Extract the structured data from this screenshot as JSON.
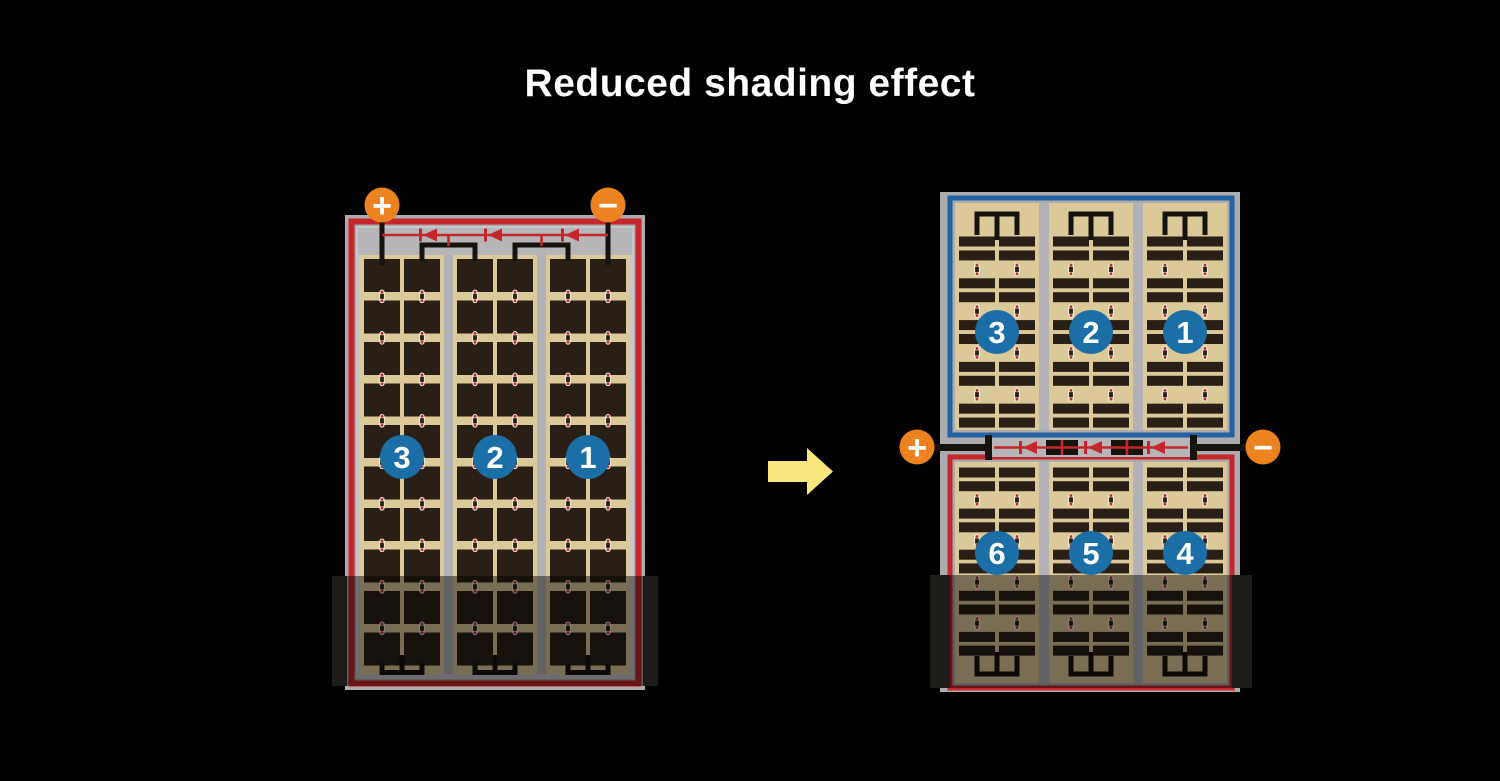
{
  "title": "Reduced shading effect",
  "left_panel": {
    "terminal_positive": "+",
    "terminal_negative": "−",
    "string_labels": [
      "3",
      "2",
      "1"
    ],
    "bypass_diode_count": 3
  },
  "right_panel": {
    "terminal_positive": "+",
    "terminal_negative": "−",
    "top_half_string_labels": [
      "3",
      "2",
      "1"
    ],
    "bottom_half_string_labels": [
      "6",
      "5",
      "4"
    ],
    "bypass_diode_count": 3
  },
  "colors": {
    "background": "#000000",
    "title_text": "#FFFFFF",
    "frame_gray": "#ACABAD",
    "wire_margin_gray": "#B6B5B7",
    "inner_margin_gray": "#C7C6C8",
    "separator_gray": "#B2B3B7",
    "cell_field_tan": "#DCC999",
    "cell_dark": "#2A1F16",
    "wire_black": "#16120E",
    "border_red": "#C4262B",
    "border_blue": "#2463A3",
    "diode_red": "#C4262B",
    "terminal_orange": "#EC8320",
    "terminal_glyph": "#FFFFFF",
    "badge_blue": "#1C6FA6",
    "badge_text": "#FFFFFF",
    "interconnect_white": "#F8F4EC",
    "interconnect_dot_red": "#C03028",
    "shade_bar": "#37342F",
    "shade_overlay": "rgba(0,0,0,0.45)",
    "arrow_yellow": "#F9E67D"
  }
}
